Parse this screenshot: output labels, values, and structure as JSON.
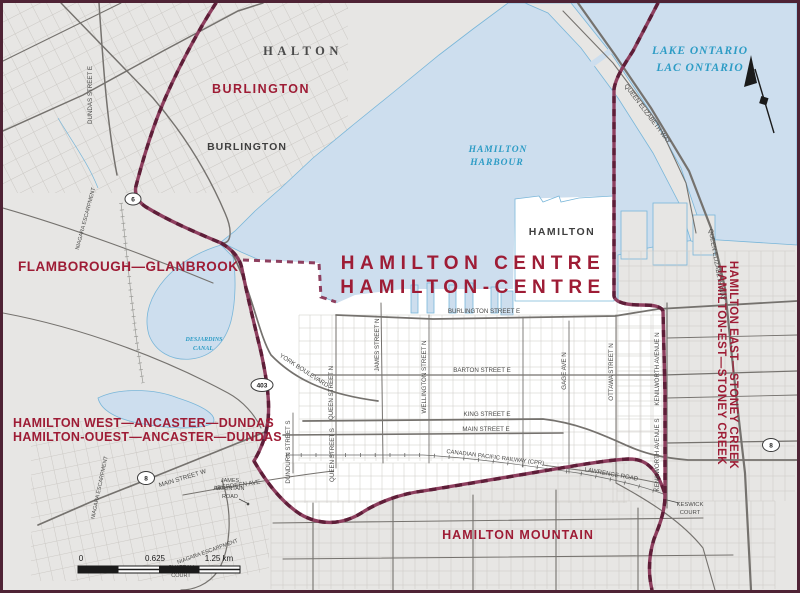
{
  "title": {
    "en": "HAMILTON CENTRE",
    "fr": "HAMILTON-CENTRE"
  },
  "districts": {
    "burlington": "BURLINGTON",
    "flamborough_glanbrook": "FLAMBOROUGH—GLANBROOK",
    "hamilton_west_en": "HAMILTON WEST—ANCASTER—DUNDAS",
    "hamilton_west_fr": "HAMILTON-OUEST—ANCASTER—DUNDAS",
    "hamilton_mountain": "HAMILTON MOUNTAIN",
    "hamilton_east_en": "HAMILTON EAST—STONEY CREEK",
    "hamilton_east_fr": "HAMILTON-EST—STONEY CREEK"
  },
  "places": {
    "halton": "HALTON",
    "burlington_city": "BURLINGTON",
    "hamilton_city": "HAMILTON"
  },
  "water": {
    "lake_en": "LAKE ONTARIO",
    "lake_fr": "LAC ONTARIO",
    "harbour_l1": "HAMILTON",
    "harbour_l2": "HARBOUR",
    "canal_l1": "DESJARDINS",
    "canal_l2": "CANAL"
  },
  "streets": {
    "dundas_e": "DUNDAS STREET E",
    "qew": "QUEEN ELIZABETH WAY",
    "burlington_st": "BURLINGTON STREET E",
    "barton": "BARTON STREET E",
    "king": "KING STREET E",
    "main_e": "MAIN STREET E",
    "main_w": "MAIN STREET W",
    "york": "YORK BOULEVARD",
    "queen_n": "QUEEN STREET N",
    "james_n": "JAMES STREET N",
    "wellington_n": "WELLINGTON STREET N",
    "gage_n": "GAGE AVE N",
    "ottawa_n": "OTTAWA STREET N",
    "kenilworth_n": "KENILWORTH AVENUE N",
    "kenilworth_s": "KENILWORTH AVENUE S",
    "queen_s": "QUEEN STREET S",
    "dundurn_s": "DUNDURN STREET S",
    "aberdeen": "ABERDEEN AVE",
    "lawrence": "LAWRENCE ROAD",
    "cpr": "CANADIAN PACIFIC RAILWAY (CPR)",
    "james_mtn_1": "JAMES",
    "james_mtn_2": "MOUNTAIN",
    "james_mtn_3": "ROAD",
    "keswick_1": "KESWICK",
    "keswick_2": "COURT",
    "chateau_1": "CHATEAU",
    "chateau_2": "COURT",
    "escarpment": "NIAGARA ESCARPMENT"
  },
  "shields": {
    "hwy6": "6",
    "hwy403": "403",
    "hwy8": "8"
  },
  "scale": {
    "zero": "0",
    "mid": "0.625",
    "end": "1.25 km"
  }
}
